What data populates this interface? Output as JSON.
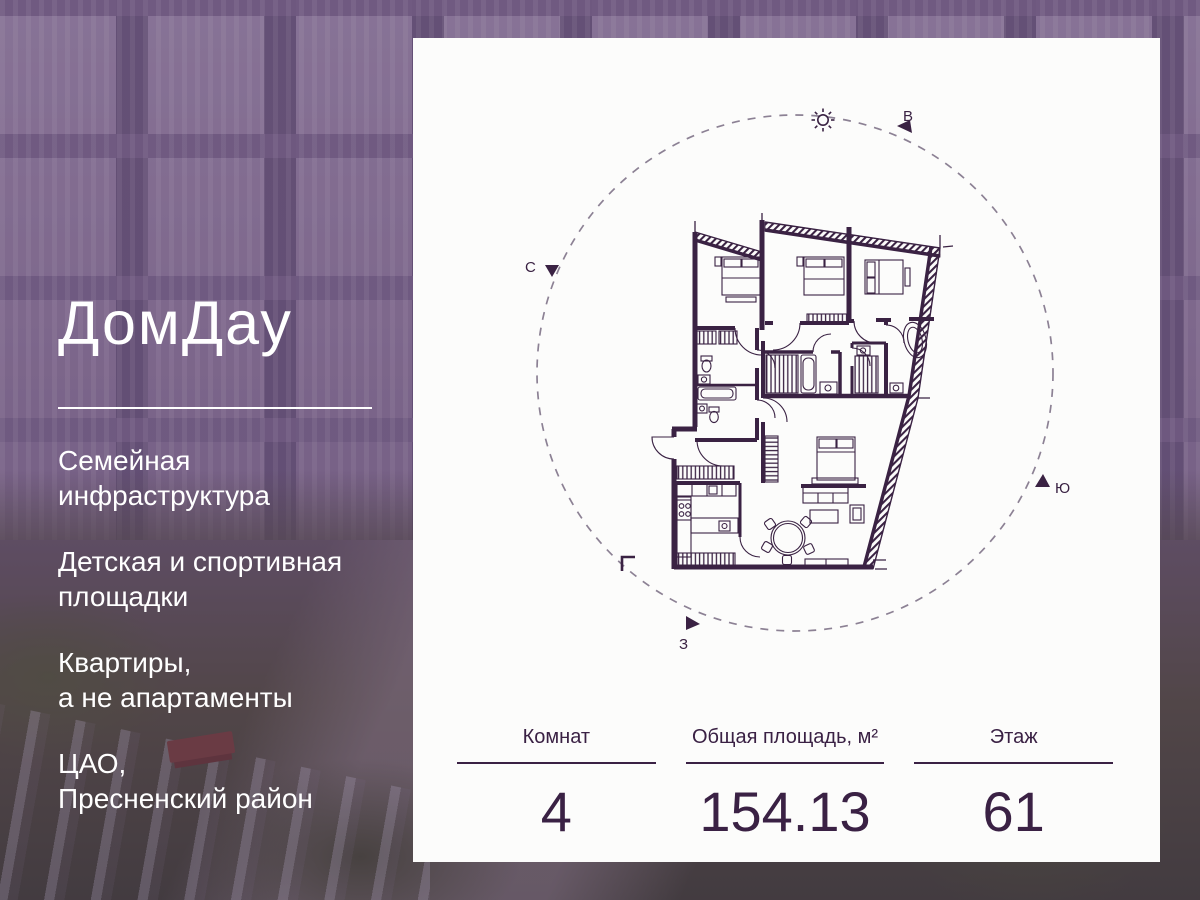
{
  "accent_color": "#3a2144",
  "photo_tint_color": "#603e6a",
  "brand": {
    "logo_text": "ДомДау"
  },
  "left_panel": {
    "features": [
      "Семейная\nинфраструктура",
      "Детская и спортивная\nплощадки",
      "Квартиры,\nа не апартаменты",
      "ЦАО,\nПресненский район"
    ]
  },
  "card": {
    "compass": {
      "north_label": "С",
      "east_label": "В",
      "south_label": "Ю",
      "west_label": "З"
    },
    "icons": {
      "sun": "sun-icon",
      "direction_arrows": "triangle-arrow-icon"
    },
    "stats": [
      {
        "label": "Комнат",
        "value": "4"
      },
      {
        "label": "Общая площадь, м²",
        "value": "154.13"
      },
      {
        "label": "Этаж",
        "value": "61"
      }
    ]
  }
}
